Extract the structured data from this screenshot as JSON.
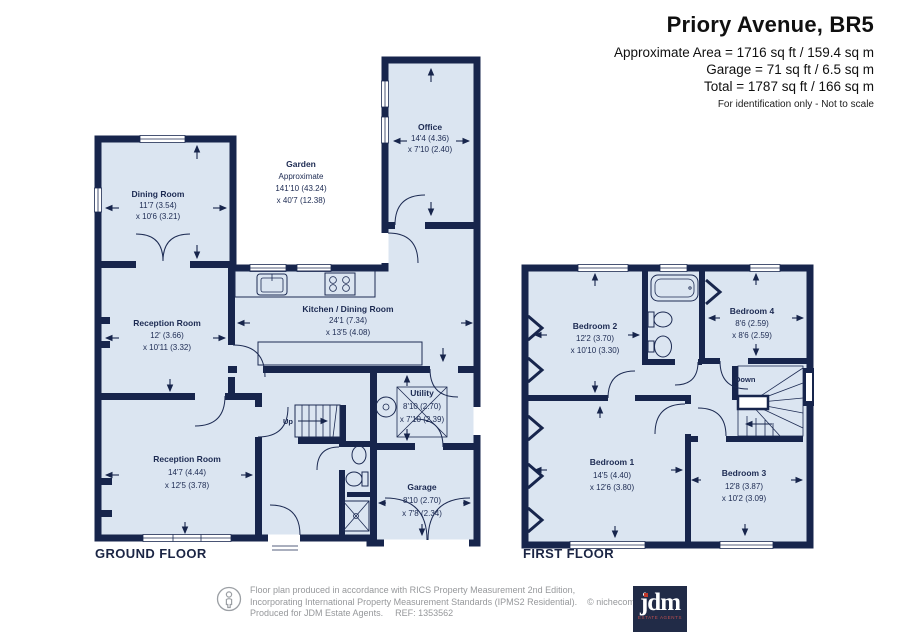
{
  "header": {
    "title": "Priory Avenue, BR5",
    "area_line1": "Approximate Area = 1716 sq ft / 159.4 sq m",
    "area_line2": "Garage = 71 sq ft / 6.5 sq m",
    "area_line3": "Total = 1787 sq ft / 166 sq m",
    "note": "For identification only - Not to scale"
  },
  "ground_floor": {
    "title": "GROUND FLOOR",
    "up_label": "Up",
    "rooms": {
      "dining_room": {
        "name": "Dining Room",
        "dim1": "11'7 (3.54)",
        "dim2": "x 10'6 (3.21)"
      },
      "garden": {
        "name": "Garden",
        "note": "Approximate",
        "dim1": "141'10 (43.24)",
        "dim2": "x 40'7 (12.38)"
      },
      "office": {
        "name": "Office",
        "dim1": "14'4 (4.36)",
        "dim2": "x 7'10 (2.40)"
      },
      "kitchen_dining": {
        "name": "Kitchen / Dining Room",
        "dim1": "24'1 (7.34)",
        "dim2": "x 13'5 (4.08)"
      },
      "reception_room_1": {
        "name": "Reception Room",
        "dim1": "12' (3.66)",
        "dim2": "x 10'11 (3.32)"
      },
      "reception_room_2": {
        "name": "Reception Room",
        "dim1": "14'7 (4.44)",
        "dim2": "x 12'5 (3.78)"
      },
      "utility": {
        "name": "Utility",
        "dim1": "8'10 (2.70)",
        "dim2": "x 7'10 (2.39)"
      },
      "garage": {
        "name": "Garage",
        "dim1": "8'10 (2.70)",
        "dim2": "x 7'8 (2.34)"
      }
    }
  },
  "first_floor": {
    "title": "FIRST FLOOR",
    "down_label": "Down",
    "rooms": {
      "bedroom_1": {
        "name": "Bedroom 1",
        "dim1": "14'5 (4.40)",
        "dim2": "x 12'6 (3.80)"
      },
      "bedroom_2": {
        "name": "Bedroom 2",
        "dim1": "12'2 (3.70)",
        "dim2": "x 10'10 (3.30)"
      },
      "bedroom_3": {
        "name": "Bedroom 3",
        "dim1": "12'8 (3.87)",
        "dim2": "x 10'2 (3.09)"
      },
      "bedroom_4": {
        "name": "Bedroom 4",
        "dim1": "8'6 (2.59)",
        "dim2": "x 8'6 (2.59)"
      }
    }
  },
  "footer": {
    "line1": "Floor plan produced in accordance with RICS Property Measurement 2nd Edition,",
    "line2": "Incorporating International Property Measurement Standards (IPMS2 Residential).",
    "copyright": "© nichecom 2025.",
    "produced": "Produced for JDM Estate Agents.",
    "ref": "REF: 1353562",
    "logo_text": "jdm",
    "logo_sub": "ESTATE AGENTS"
  },
  "colors": {
    "wall_navy": "#17254c",
    "room_fill": "#dbe5f1",
    "label_navy": "#1c2a52",
    "logo_navy": "#212b47",
    "logo_red": "#c0392b",
    "footer_gray": "#96989b"
  }
}
